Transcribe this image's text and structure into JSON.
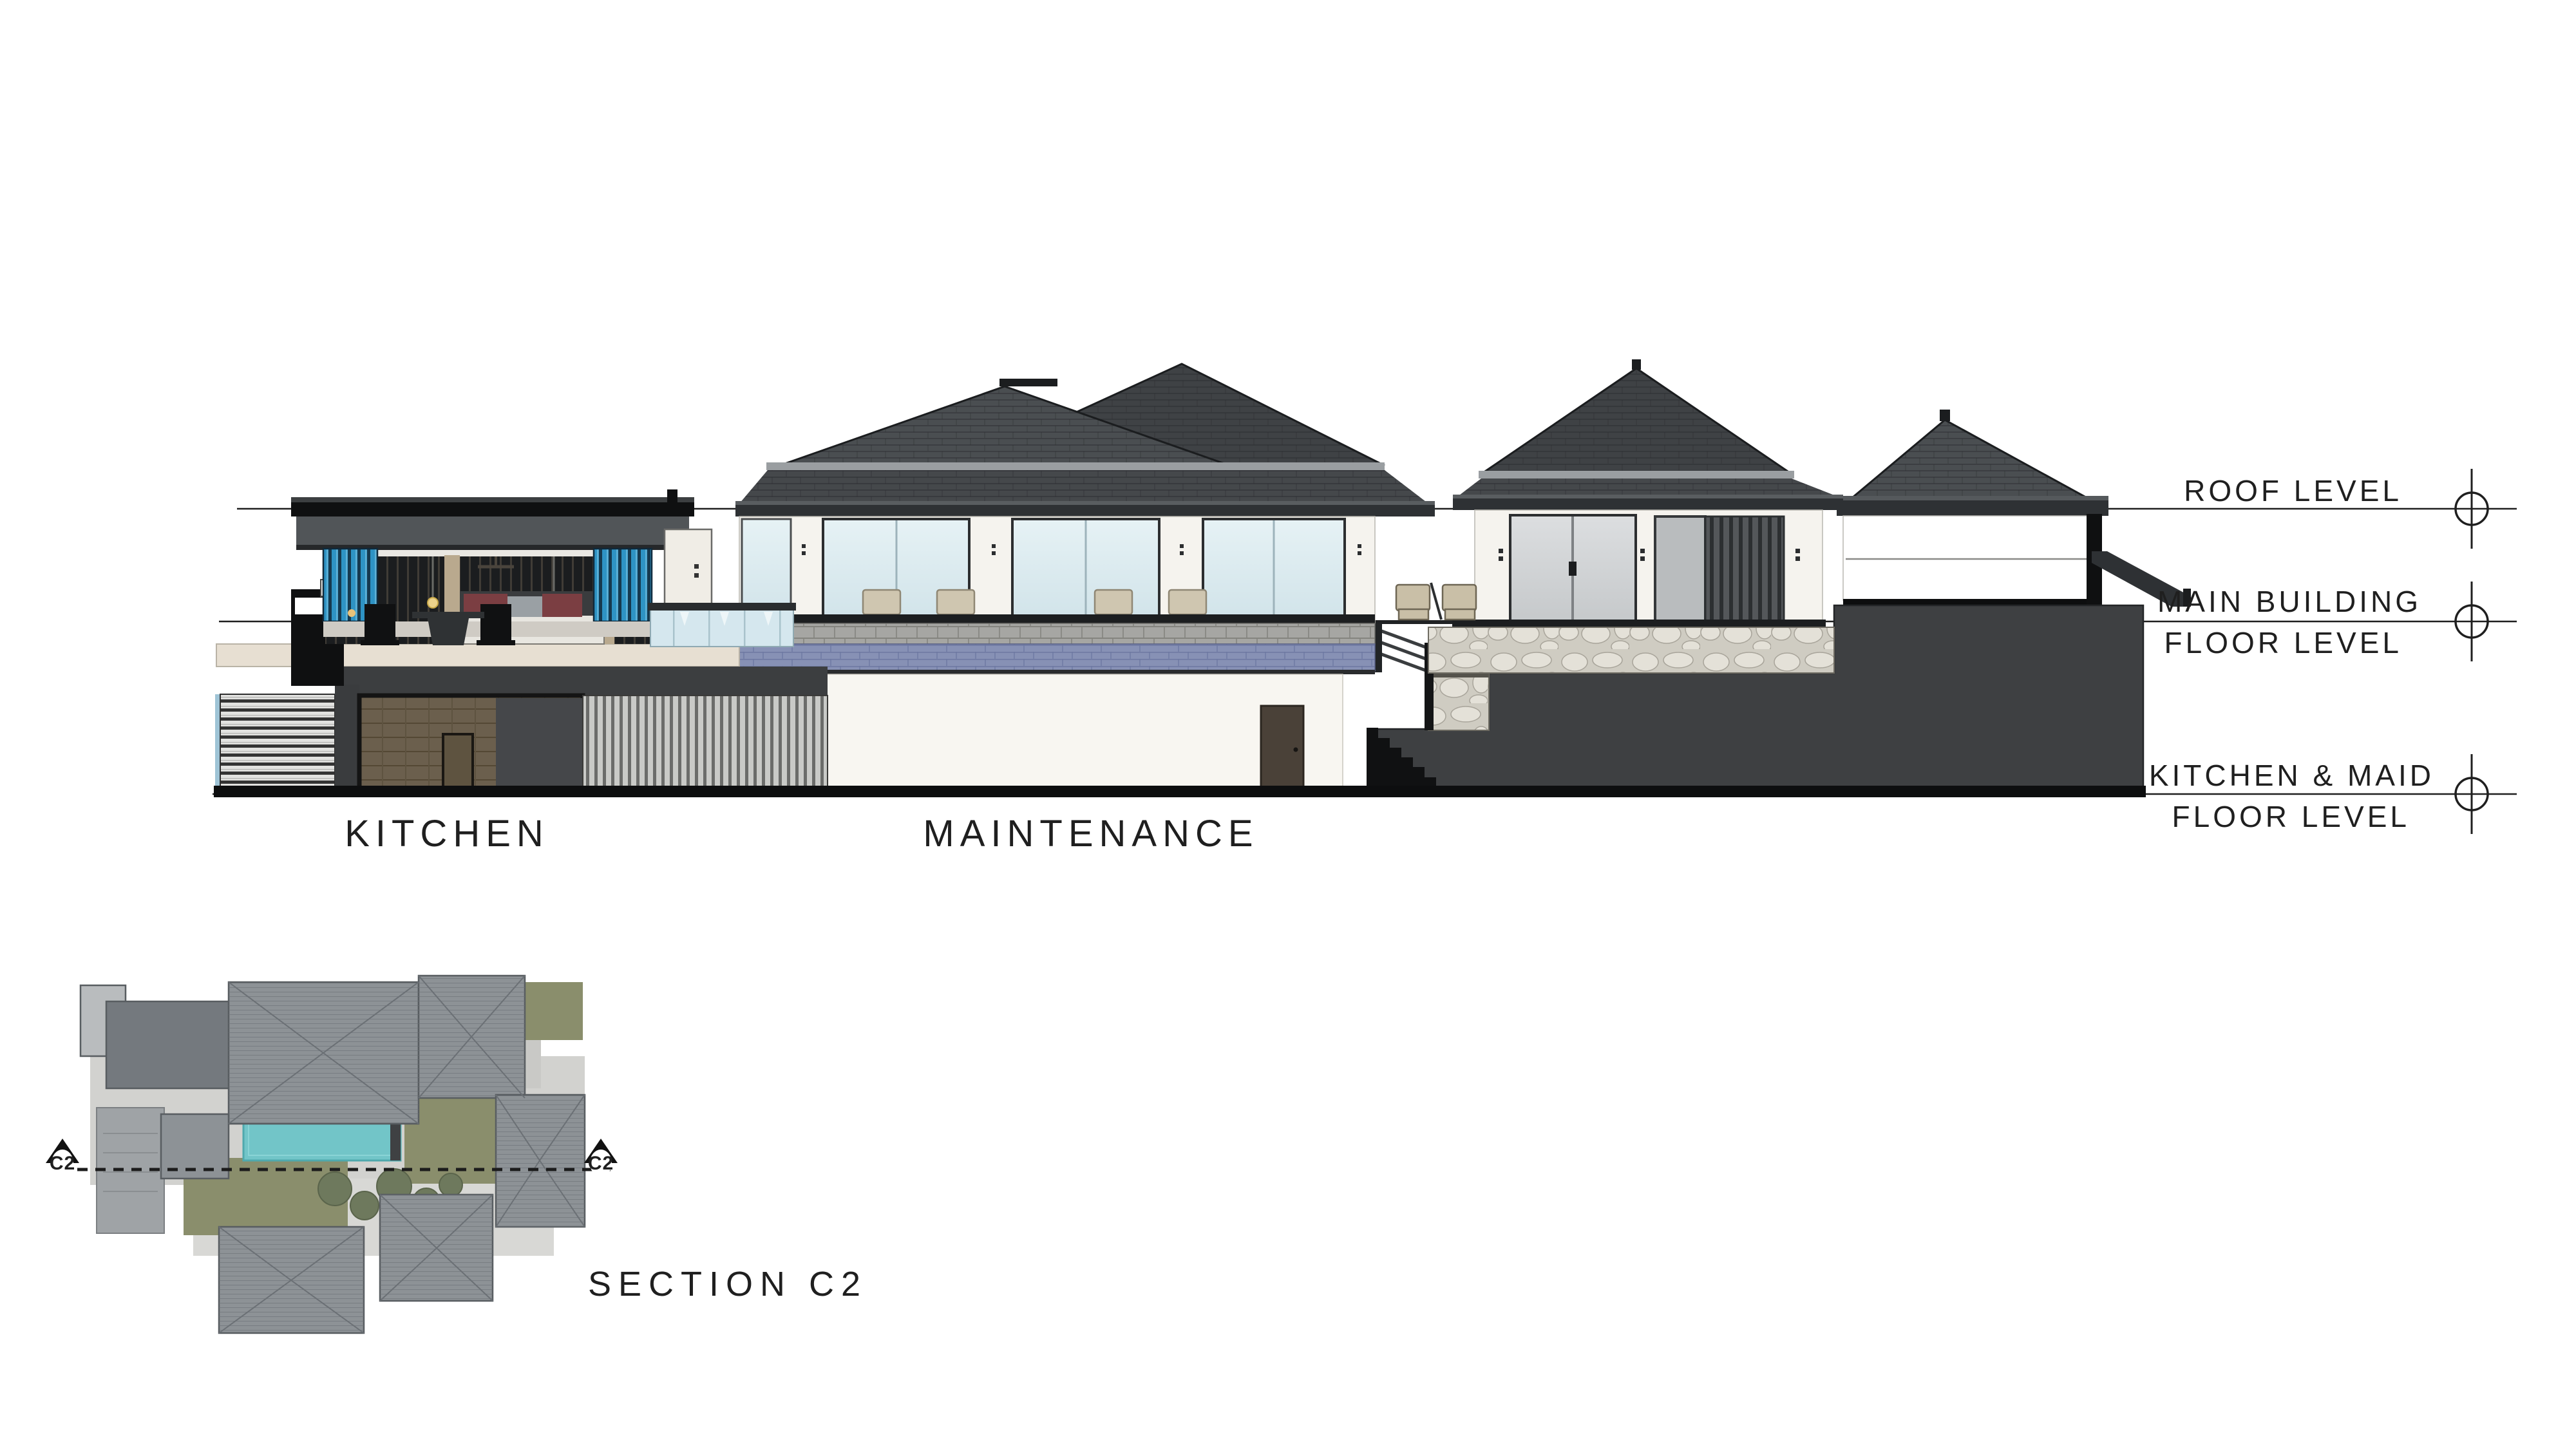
{
  "drawing": {
    "type": "architectural section",
    "sheet_background": "#ffffff"
  },
  "levels": {
    "roof": {
      "label": "ROOF LEVEL"
    },
    "main": {
      "line1": "MAIN BUILDING",
      "line2": "FLOOR LEVEL"
    },
    "kitchen_maid": {
      "line1": "KITCHEN & MAID",
      "line2": "FLOOR LEVEL"
    }
  },
  "room_labels": {
    "kitchen": "KITCHEN",
    "maintenance": "MAINTENANCE"
  },
  "section": {
    "label": "SECTION  C2",
    "marker_left": "C2",
    "marker_right": "C2"
  },
  "colors": {
    "ink": "#1f1f1f",
    "roof_dark": "#3f4245",
    "roof_mid": "#4a4e51",
    "fascia_dark": "#2e3134",
    "band_gray": "#9a9ea1",
    "wall_white": "#f5f3ee",
    "lower_wall_white": "#f8f6f1",
    "glass_blue_top": "#e6f2f5",
    "glass_blue_bot": "#d2e4ea",
    "glass_gray": "#d4d7d9",
    "louver_blue": "#2e93c4",
    "louver_blue_dark": "#16394e",
    "curtain_dark": "#1b1d1f",
    "tile_brown": "#6b5f4d",
    "stone_bg": "#cfccc2",
    "stone_face": "#e4e1d8",
    "paver_gray": "#a6a6a3",
    "pool_tile": "#8791b5",
    "slab_beige": "#e7dfd2",
    "ground_dark": "#3e4042",
    "black": "#0d0e0f",
    "plan_roof": "#8d9296",
    "plan_roof_dark": "#74797e",
    "pool_teal": "#72c5c8",
    "lawn_olive": "#8a8e6c",
    "tree_olive": "#6e795d",
    "path_gray": "#d2d2cf"
  }
}
